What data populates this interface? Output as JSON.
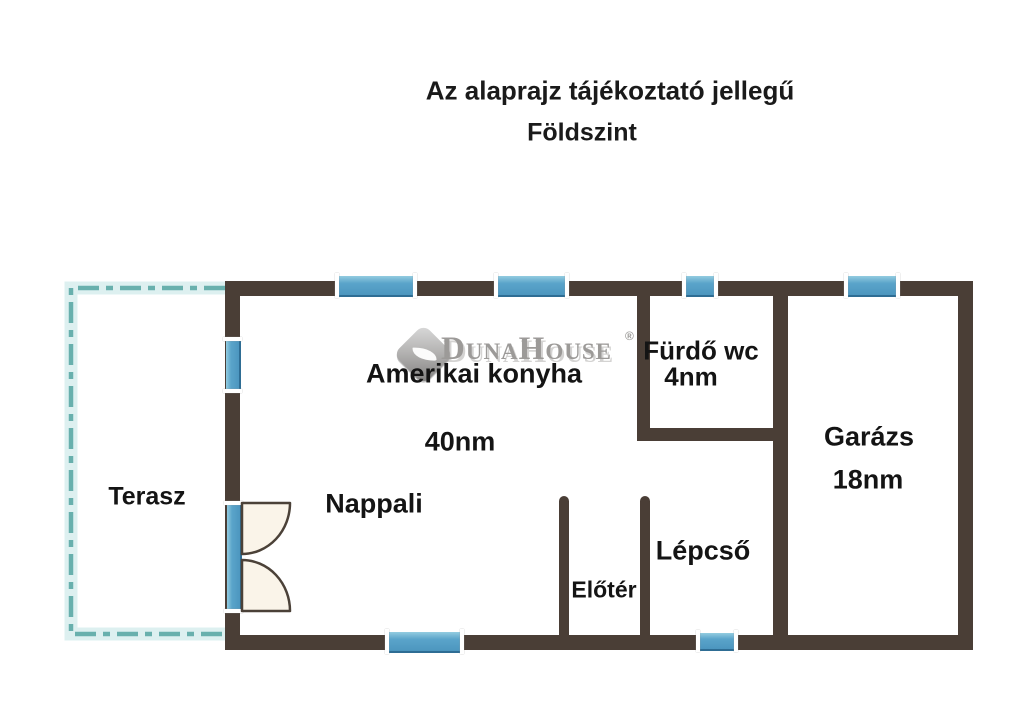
{
  "header": {
    "disclaimer": "Az alaprajz tájékoztató jellegű",
    "floor": "Földszint"
  },
  "watermark": {
    "brand": "DunaHouse",
    "registered": "®",
    "logo_icon": "diamond-leaf-icon"
  },
  "rooms": {
    "terasz": {
      "name": "Terasz"
    },
    "konyha": {
      "name": "Amerikai konyha",
      "area": "40nm"
    },
    "nappali": {
      "name": "Nappali"
    },
    "furdo": {
      "name": "Fürdő wc",
      "area": "4nm"
    },
    "garazs": {
      "name": "Garázs",
      "area": "18nm"
    },
    "lepcso": {
      "name": "Lépcső"
    },
    "eloter": {
      "name": "Előtér"
    }
  },
  "colors": {
    "wall": "#4a3e36",
    "window_blue": "#4f9cc6",
    "window_highlight": "#93cce0",
    "window_edge": "#2e6d94",
    "terrace_teal": "#68b0ad",
    "terrace_halo": "#d9eeee",
    "door_leaf_fill": "#faf4e9",
    "watermark_gray": "#9c9a98",
    "text_black": "#141414",
    "background": "#ffffff"
  }
}
